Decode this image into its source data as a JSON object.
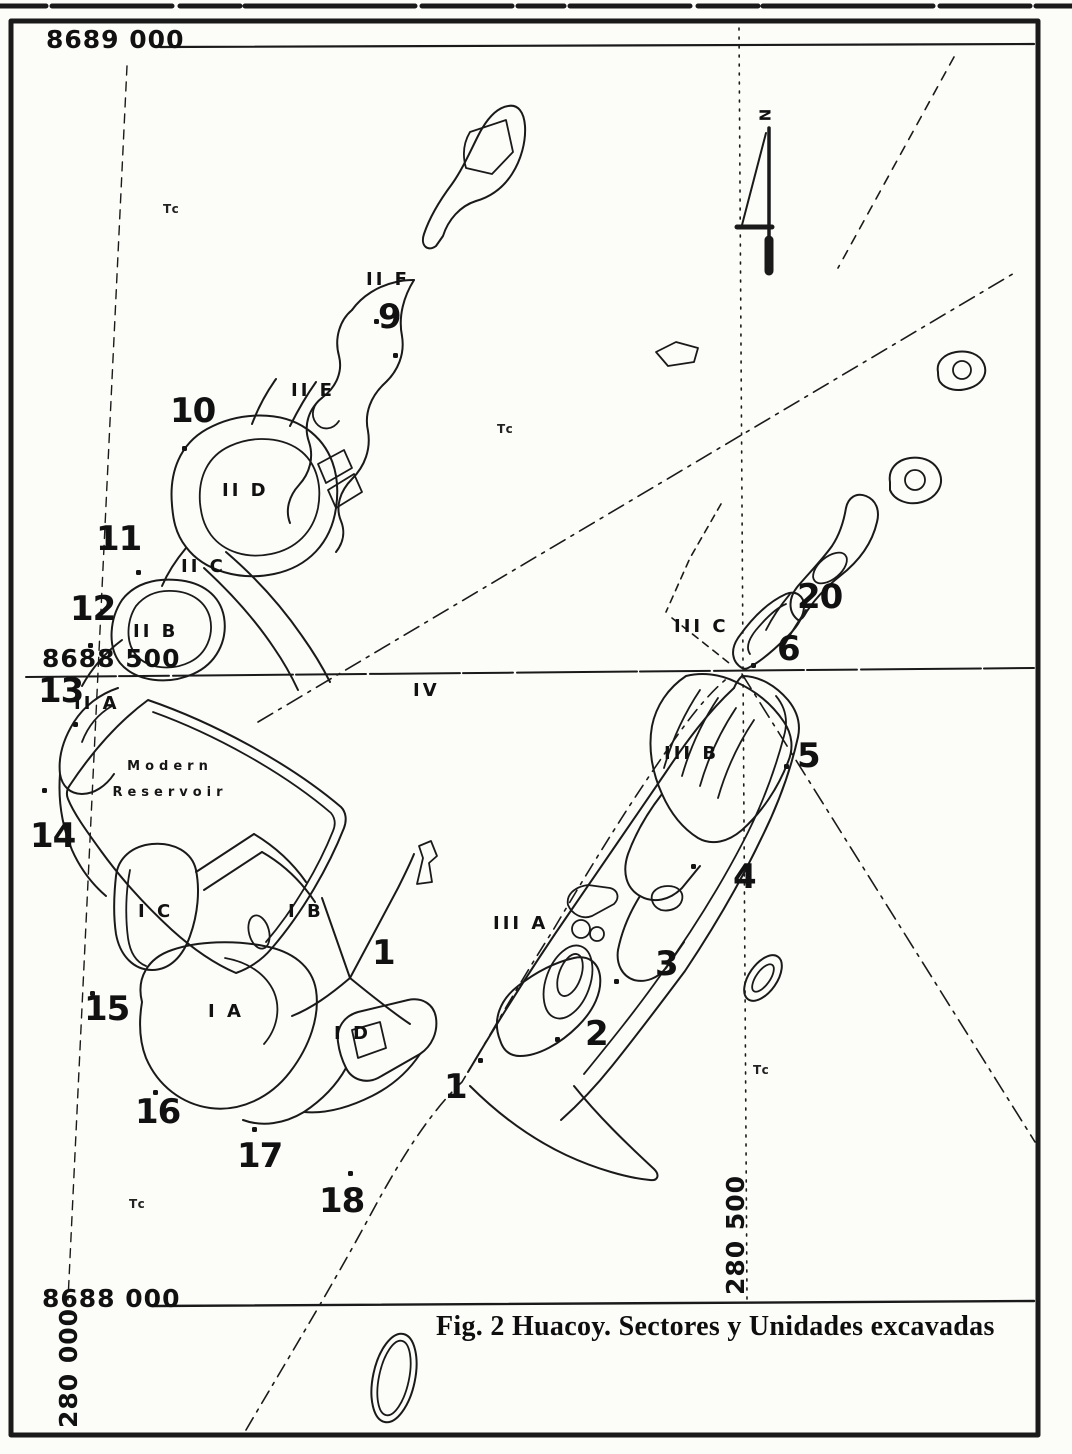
{
  "figure": {
    "caption": "Fig. 2 Huacoy. Sectores y Unidades excavadas"
  },
  "north_arrow": {
    "label": "N"
  },
  "reservoir_label": {
    "line1": "Modern",
    "line2": "Reservoir"
  },
  "grid": {
    "horizontal_labels": [
      {
        "t": "8689 000",
        "x": 46,
        "y": 27
      },
      {
        "t": "8688 500",
        "x": 42,
        "y": 646
      },
      {
        "t": "8688 000",
        "x": 42,
        "y": 1286
      }
    ],
    "vertical_labels": [
      {
        "t": "280 000",
        "x": 56,
        "y": 1428
      },
      {
        "t": "280 500",
        "x": 723,
        "y": 1295
      }
    ]
  },
  "units": [
    {
      "n": "9",
      "x": 378,
      "y": 300
    },
    {
      "n": "10",
      "x": 170,
      "y": 394
    },
    {
      "n": "11",
      "x": 96,
      "y": 522
    },
    {
      "n": "12",
      "x": 70,
      "y": 592
    },
    {
      "n": "13",
      "x": 38,
      "y": 674
    },
    {
      "n": "14",
      "x": 30,
      "y": 819
    },
    {
      "n": "15",
      "x": 84,
      "y": 992
    },
    {
      "n": "16",
      "x": 135,
      "y": 1095
    },
    {
      "n": "17",
      "x": 237,
      "y": 1139
    },
    {
      "n": "18",
      "x": 319,
      "y": 1184
    },
    {
      "n": "1",
      "x": 372,
      "y": 936
    },
    {
      "n": "1",
      "x": 444,
      "y": 1070
    },
    {
      "n": "2",
      "x": 585,
      "y": 1017
    },
    {
      "n": "3",
      "x": 655,
      "y": 947
    },
    {
      "n": "4",
      "x": 733,
      "y": 860
    },
    {
      "n": "5",
      "x": 797,
      "y": 739
    },
    {
      "n": "6",
      "x": 777,
      "y": 632
    },
    {
      "n": "20",
      "x": 797,
      "y": 580
    }
  ],
  "sector_labels": [
    {
      "t": "II F",
      "x": 366,
      "y": 271
    },
    {
      "t": "II E",
      "x": 291,
      "y": 382
    },
    {
      "t": "II D",
      "x": 222,
      "y": 482
    },
    {
      "t": "II C",
      "x": 181,
      "y": 558
    },
    {
      "t": "II B",
      "x": 133,
      "y": 623
    },
    {
      "t": "II A",
      "x": 74,
      "y": 695
    },
    {
      "t": "I C",
      "x": 138,
      "y": 903
    },
    {
      "t": "I B",
      "x": 288,
      "y": 903
    },
    {
      "t": "I A",
      "x": 208,
      "y": 1003
    },
    {
      "t": "I D",
      "x": 334,
      "y": 1025
    },
    {
      "t": "III A",
      "x": 493,
      "y": 915
    },
    {
      "t": "III B",
      "x": 664,
      "y": 745
    },
    {
      "t": "III C",
      "x": 674,
      "y": 618
    },
    {
      "t": "IV",
      "x": 413,
      "y": 682
    }
  ],
  "terrain_labels": [
    {
      "t": "Tc",
      "x": 163,
      "y": 203
    },
    {
      "t": "Tc",
      "x": 497,
      "y": 423
    },
    {
      "t": "Tc",
      "x": 753,
      "y": 1064
    },
    {
      "t": "Tc",
      "x": 129,
      "y": 1198
    }
  ],
  "markers": [
    {
      "x": 374,
      "y": 319
    },
    {
      "x": 393,
      "y": 353
    },
    {
      "x": 182,
      "y": 446
    },
    {
      "x": 136,
      "y": 570
    },
    {
      "x": 88,
      "y": 643
    },
    {
      "x": 73,
      "y": 722
    },
    {
      "x": 42,
      "y": 788
    },
    {
      "x": 90,
      "y": 991
    },
    {
      "x": 153,
      "y": 1090
    },
    {
      "x": 252,
      "y": 1127
    },
    {
      "x": 348,
      "y": 1171
    },
    {
      "x": 478,
      "y": 1058
    },
    {
      "x": 555,
      "y": 1037
    },
    {
      "x": 614,
      "y": 979
    },
    {
      "x": 691,
      "y": 864
    },
    {
      "x": 784,
      "y": 764
    },
    {
      "x": 751,
      "y": 663
    }
  ]
}
